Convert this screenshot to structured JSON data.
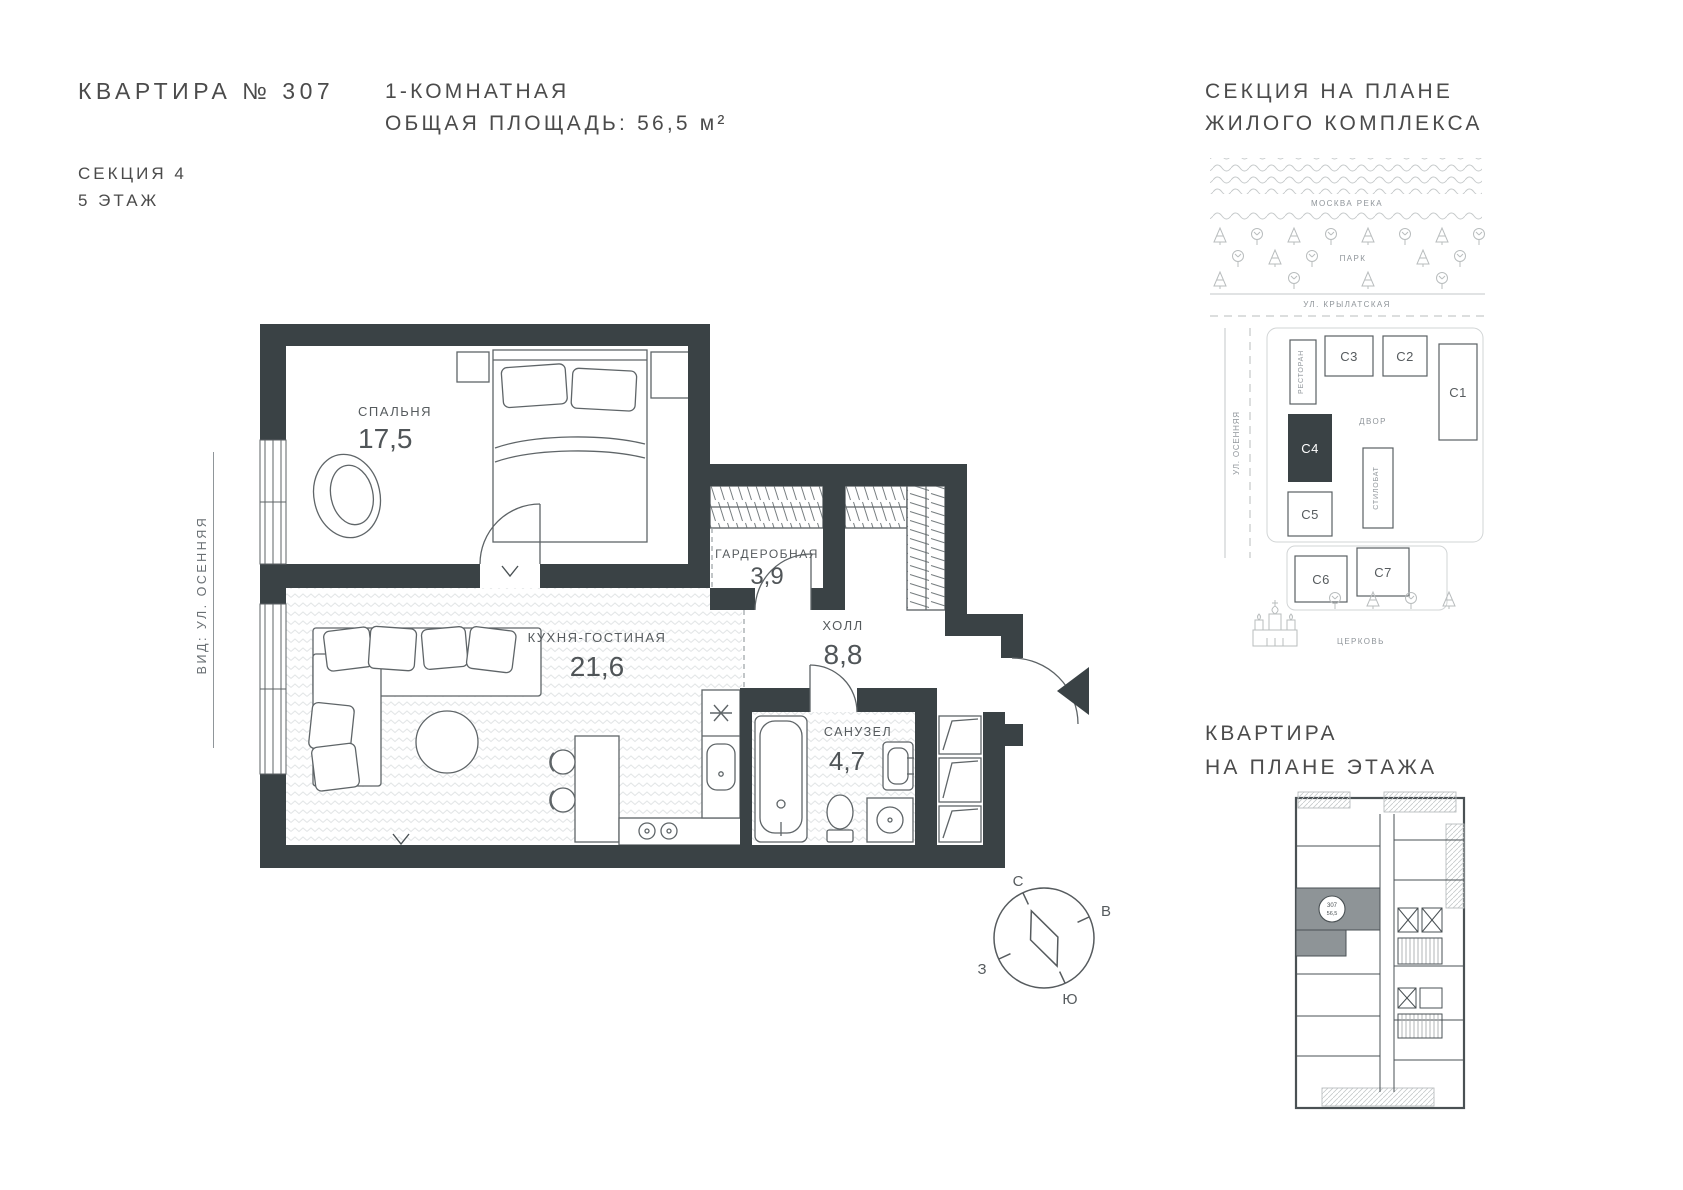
{
  "header": {
    "apartment_title": "КВАРТИРА № 307",
    "section": "СЕКЦИЯ 4",
    "floor": "5 ЭТАЖ",
    "rooms_line": "1-КОМНАТНАЯ",
    "area_line": "ОБЩАЯ ПЛОЩАДЬ: 56,5 м²"
  },
  "site_plan": {
    "title_line1": "СЕКЦИЯ НА ПЛАНЕ",
    "title_line2": "ЖИЛОГО КОМПЛЕКСА",
    "river": "МОСКВА РЕКА",
    "park": "ПАРК",
    "street_top": "УЛ. КРЫЛАТСКАЯ",
    "street_left": "УЛ. ОСЕННЯЯ",
    "restaurant": "РЕСТОРАН",
    "courtyard": "ДВОР",
    "stylobate": "СТИЛОБАТ",
    "church": "ЦЕРКОВЬ",
    "buildings": [
      "С1",
      "С2",
      "С3",
      "С4",
      "С5",
      "С6",
      "С7"
    ],
    "highlighted_building": "С4"
  },
  "floor_plan": {
    "view_label": "ВИД: УЛ. ОСЕННЯЯ",
    "rooms": [
      {
        "name": "СПАЛЬНЯ",
        "area": "17,5"
      },
      {
        "name": "ГАРДЕРОБНАЯ",
        "area": "3,9"
      },
      {
        "name": "КУХНЯ-ГОСТИНАЯ",
        "area": "21,6"
      },
      {
        "name": "ХОЛЛ",
        "area": "8,8"
      },
      {
        "name": "САНУЗЕЛ",
        "area": "4,7"
      }
    ]
  },
  "compass": {
    "north": "С",
    "east": "В",
    "south": "Ю",
    "west": "З"
  },
  "mini_plan": {
    "title_line1": "КВАРТИРА",
    "title_line2": "НА ПЛАНЕ ЭТАЖА",
    "badge_number": "307",
    "badge_area": "56,5"
  },
  "colors": {
    "wall": "#3a4245",
    "text": "#4b4b4b",
    "line": "#5d6366"
  }
}
